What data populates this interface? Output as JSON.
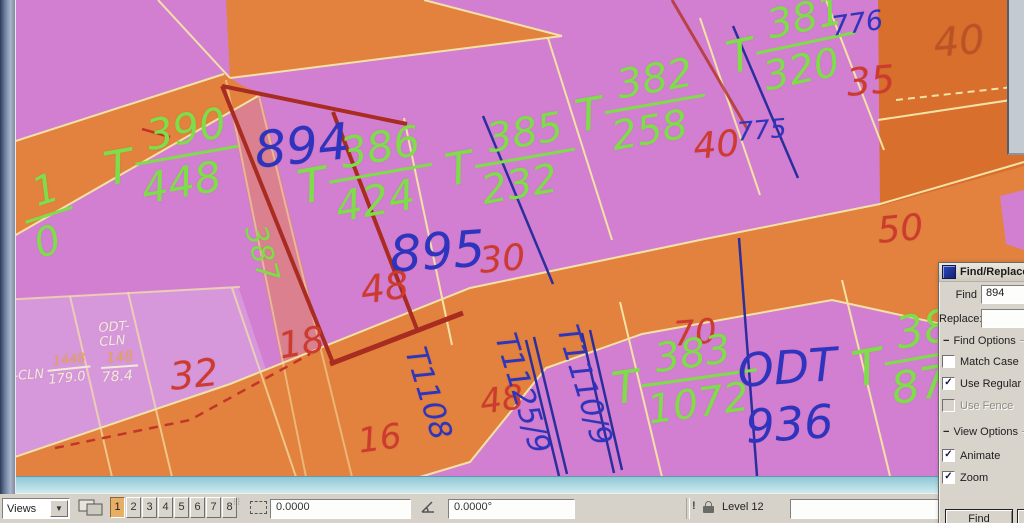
{
  "map": {
    "colors": {
      "green": "#7fdd4a",
      "blue": "#2e34bd",
      "red": "#cd3a2e",
      "faintred": "rgba(165,55,35,0.42)",
      "white": "#f2ead8",
      "orange": "#e6a352",
      "pink_parcel": "#d37fd1",
      "road_orange": "#e2823e",
      "boundary_yellow": "#f3e2a6",
      "highlight_red": "#a82c20"
    },
    "labels": [
      {
        "id": "frac-390-448",
        "kind": "frac",
        "t": "T",
        "num": "390",
        "den": "448",
        "x": 96,
        "y": 124,
        "rot": -10,
        "size": 42,
        "color": "green"
      },
      {
        "id": "num-894",
        "kind": "text",
        "text": "894",
        "x": 252,
        "y": 126,
        "rot": -6,
        "size": 50,
        "color": "blue"
      },
      {
        "id": "frac-386-424",
        "kind": "frac",
        "t": "T",
        "num": "386",
        "den": "424",
        "x": 290,
        "y": 142,
        "rot": -10,
        "size": 42,
        "color": "green"
      },
      {
        "id": "frac-385-232",
        "kind": "frac",
        "t": "T",
        "num": "385",
        "den": "232",
        "x": 438,
        "y": 128,
        "rot": -10,
        "size": 40,
        "color": "green"
      },
      {
        "id": "frac-382-258",
        "kind": "frac",
        "t": "T",
        "num": "382",
        "den": "258",
        "x": 568,
        "y": 74,
        "rot": -10,
        "size": 40,
        "color": "green"
      },
      {
        "id": "frac-381-320",
        "kind": "frac",
        "t": "T",
        "num": "381",
        "den": "320",
        "x": 718,
        "y": 16,
        "rot": -12,
        "size": 40,
        "color": "green"
      },
      {
        "id": "num-776",
        "kind": "text",
        "text": "776",
        "x": 830,
        "y": 14,
        "rot": -8,
        "size": 27,
        "color": "blue"
      },
      {
        "id": "num-35",
        "kind": "text",
        "text": "35",
        "x": 845,
        "y": 64,
        "rot": -5,
        "size": 38,
        "color": "red"
      },
      {
        "id": "num-40-faint",
        "kind": "text",
        "text": "40",
        "x": 932,
        "y": 24,
        "rot": -5,
        "size": 40,
        "color": "faintred"
      },
      {
        "id": "num-40",
        "kind": "text",
        "text": "40",
        "x": 692,
        "y": 130,
        "rot": -5,
        "size": 36,
        "color": "red"
      },
      {
        "id": "num-775",
        "kind": "text",
        "text": "775",
        "x": 736,
        "y": 120,
        "rot": -5,
        "size": 26,
        "color": "blue"
      },
      {
        "id": "num-895",
        "kind": "text",
        "text": "895",
        "x": 388,
        "y": 230,
        "rot": -4,
        "size": 50,
        "color": "blue"
      },
      {
        "id": "num-30",
        "kind": "text",
        "text": "30",
        "x": 478,
        "y": 244,
        "rot": -5,
        "size": 36,
        "color": "red"
      },
      {
        "id": "num-50",
        "kind": "text",
        "text": "50",
        "x": 876,
        "y": 214,
        "rot": -5,
        "size": 36,
        "color": "red"
      },
      {
        "id": "num-48a",
        "kind": "text",
        "text": "48",
        "x": 358,
        "y": 272,
        "rot": -8,
        "size": 38,
        "color": "red"
      },
      {
        "id": "vert-387",
        "kind": "text",
        "text": "387",
        "x": 268,
        "y": 222,
        "rot": 75,
        "size": 30,
        "color": "green"
      },
      {
        "id": "num-18",
        "kind": "text",
        "text": "18",
        "x": 276,
        "y": 330,
        "rot": -10,
        "size": 36,
        "color": "red"
      },
      {
        "id": "num-32",
        "kind": "text",
        "text": "32",
        "x": 168,
        "y": 358,
        "rot": -6,
        "size": 38,
        "color": "red"
      },
      {
        "id": "num-16",
        "kind": "text",
        "text": "16",
        "x": 356,
        "y": 425,
        "rot": -8,
        "size": 34,
        "color": "red"
      },
      {
        "id": "vert-T1108",
        "kind": "text",
        "text": "T1108",
        "x": 428,
        "y": 344,
        "rot": 73,
        "size": 30,
        "color": "blue"
      },
      {
        "id": "num-48b",
        "kind": "text",
        "text": "48",
        "x": 478,
        "y": 386,
        "rot": -8,
        "size": 34,
        "color": "red"
      },
      {
        "id": "vert-T1125-9",
        "kind": "text",
        "text": "T1125/9",
        "x": 518,
        "y": 330,
        "rot": 73,
        "size": 30,
        "color": "blue"
      },
      {
        "id": "vert-T1110-9",
        "kind": "text",
        "text": "T1110/9",
        "x": 580,
        "y": 322,
        "rot": 73,
        "size": 30,
        "color": "blue"
      },
      {
        "id": "num-70",
        "kind": "text",
        "text": "70",
        "x": 672,
        "y": 318,
        "rot": -5,
        "size": 34,
        "color": "red"
      },
      {
        "id": "frac-383-1072",
        "kind": "frac",
        "t": "T",
        "num": "383",
        "den": "1072",
        "x": 606,
        "y": 346,
        "rot": -8,
        "size": 40,
        "color": "green"
      },
      {
        "id": "text-ODT",
        "kind": "text",
        "text": "ODT",
        "x": 736,
        "y": 348,
        "rot": -4,
        "size": 46,
        "color": "blue"
      },
      {
        "id": "num-936",
        "kind": "text",
        "text": "936",
        "x": 744,
        "y": 404,
        "rot": -4,
        "size": 46,
        "color": "blue"
      },
      {
        "id": "frac-380-872",
        "kind": "frac",
        "t": "T",
        "num": "380",
        "den": "872",
        "x": 844,
        "y": 322,
        "rot": -10,
        "size": 44,
        "color": "green"
      },
      {
        "id": "frac-1-0",
        "kind": "frac",
        "t": "",
        "num": "1",
        "den": "0",
        "x": 12,
        "y": 180,
        "rot": -18,
        "size": 40,
        "color": "green"
      },
      {
        "id": "text-odt-cln",
        "kind": "lines",
        "lines": [
          "ODT-",
          "CLN"
        ],
        "x": 98,
        "y": 322,
        "rot": -4,
        "size": 13,
        "color": "white"
      },
      {
        "id": "frac-148-784",
        "kind": "frac2",
        "num": "148",
        "den": "78.4",
        "x": 100,
        "y": 352,
        "rot": -4,
        "size": 14,
        "color": "white",
        "numColor": "orange",
        "denColor": "white"
      },
      {
        "id": "text-cln",
        "kind": "text",
        "text": "-CLN",
        "x": 13,
        "y": 370,
        "rot": -4,
        "size": 13,
        "color": "white"
      },
      {
        "id": "frac-1448-1790",
        "kind": "frac2",
        "num": "1448",
        "den": "179.0",
        "x": 46,
        "y": 356,
        "rot": -6,
        "size": 13,
        "color": "white",
        "numColor": "orange",
        "denColor": "white"
      }
    ]
  },
  "find_dialog": {
    "title": "Find/Replace",
    "find_label": "Find",
    "find_value": "894",
    "replace_label": "Replace:",
    "find_options_label": "Find Options",
    "view_options_label": "View Options",
    "checkboxes": [
      {
        "label": "Match Case",
        "checked": false,
        "disabled": false
      },
      {
        "label": "Use Regular E",
        "checked": true,
        "disabled": false
      },
      {
        "label": "Use Fence",
        "checked": false,
        "disabled": true
      },
      {
        "label": "Animate",
        "checked": true,
        "disabled": false
      },
      {
        "label": "Zoom",
        "checked": true,
        "disabled": false
      }
    ],
    "find_button": "Find"
  },
  "status_bar": {
    "views_label": "Views",
    "view_buttons": [
      "1",
      "2",
      "3",
      "4",
      "5",
      "6",
      "7",
      "8"
    ],
    "active_view": "1",
    "distance_value": "0.0000",
    "angle_value": "0.0000°",
    "level_label": "Level 12",
    "extra_field_value": ""
  }
}
